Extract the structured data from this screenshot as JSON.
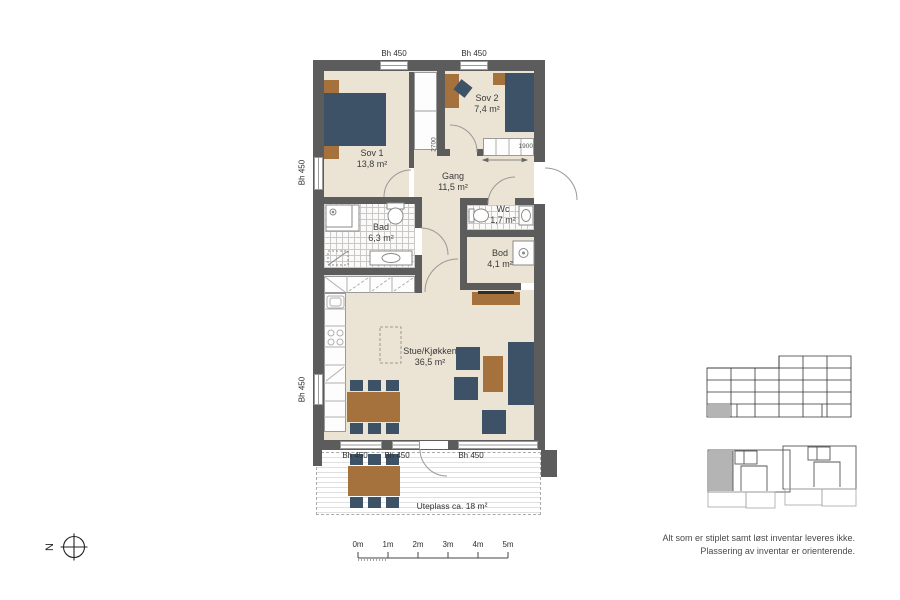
{
  "plan_title": "apartment-floor-plan",
  "rooms": [
    {
      "name": "Sov 1",
      "area": "13,8 m²"
    },
    {
      "name": "Sov 2",
      "area": "7,4 m²"
    },
    {
      "name": "Gang",
      "area": "11,5 m²"
    },
    {
      "name": "Bad",
      "area": "6,3 m²"
    },
    {
      "name": "Wc",
      "area": "1,7 m²"
    },
    {
      "name": "Bod",
      "area": "4,1 m²"
    },
    {
      "name": "Stue/Kjøkken",
      "area": "36,5 m²"
    },
    {
      "name": "Uteplass",
      "label": "Uteplass ca. 18 m²"
    }
  ],
  "windows": {
    "sill_label": "Bh 450",
    "count_visible": 7
  },
  "dimensions": {
    "wardrobe_length": "2700",
    "hall_closet_width": "1900"
  },
  "scalebar": {
    "labels": [
      "0m",
      "1m",
      "2m",
      "3m",
      "4m",
      "5m"
    ]
  },
  "compass": {
    "north": "N"
  },
  "notes": {
    "line1": "Alt som er stiplet samt løst inventar leveres ikke.",
    "line2": "Plassering av inventar er orienterende."
  },
  "colors": {
    "wall": "#5c5c5c",
    "floor": "#ebe3d4",
    "furniture_blue": "#3d5266",
    "furniture_brown": "#a5723e",
    "keyplan_highlight": "#b4b4b4"
  }
}
